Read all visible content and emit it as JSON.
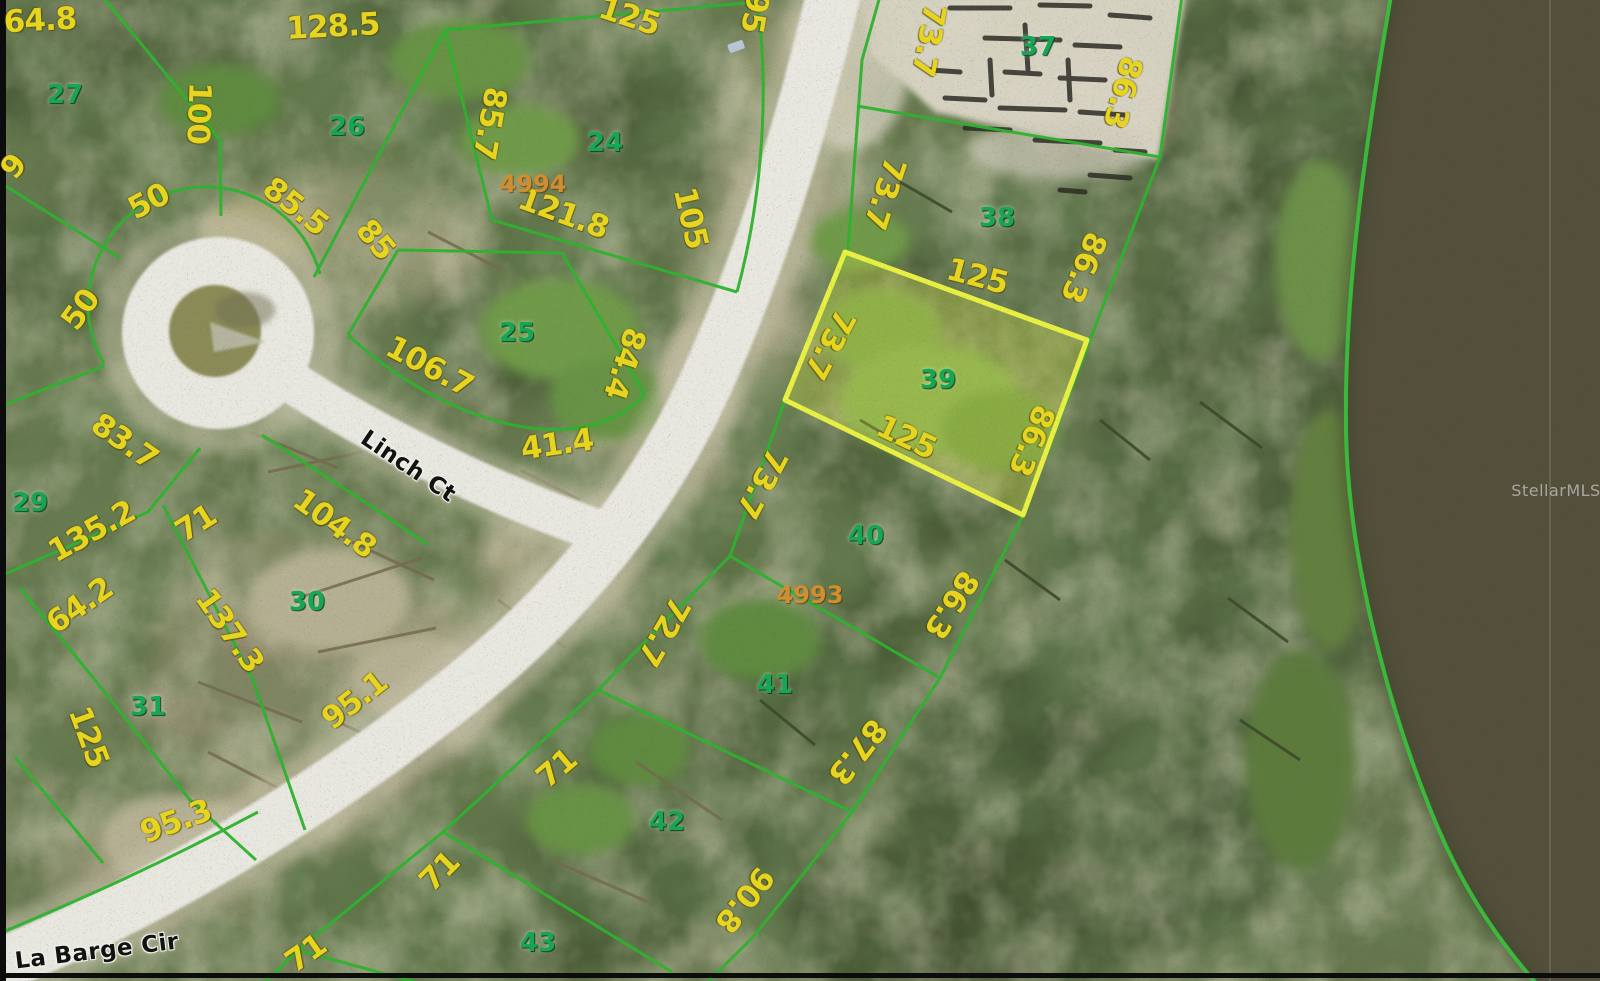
{
  "map": {
    "type": "aerial-parcel-map",
    "streets": [
      "Linch Ct",
      "La Barge Cir"
    ],
    "lot_numbers": [
      "24",
      "25",
      "26",
      "27",
      "29",
      "30",
      "31",
      "37",
      "38",
      "39",
      "40",
      "41",
      "42",
      "43"
    ],
    "parcel_ids": [
      "4994",
      "4993"
    ],
    "highlighted_lot": "39",
    "watermark": "StellarMLS",
    "colors": {
      "lot_line": "#2fb32f",
      "highlight_line": "#e9f043",
      "highlight_fill": "rgba(225,238,70,0.28)",
      "dimension_text": "#e7d41f",
      "lot_number_text": "#17a653",
      "parcel_id_text": "#d08e2e",
      "street_text": "#121212",
      "road": "#e8e7e0",
      "lake": "#53503a",
      "terrain": "#64734b"
    }
  },
  "labels": [
    {
      "t": "64.8",
      "k": "d",
      "x": 40,
      "y": 21,
      "r": -3
    },
    {
      "t": "128.5",
      "k": "d",
      "x": 333,
      "y": 27,
      "r": -3
    },
    {
      "t": "100",
      "k": "d",
      "x": 198,
      "y": 113,
      "r": 92
    },
    {
      "t": "9",
      "k": "d",
      "x": 14,
      "y": 167,
      "r": -50
    },
    {
      "t": "50",
      "k": "d",
      "x": 149,
      "y": 202,
      "r": -28
    },
    {
      "t": "85.5",
      "k": "d",
      "x": 295,
      "y": 207,
      "r": 38
    },
    {
      "t": "85",
      "k": "d",
      "x": 375,
      "y": 240,
      "r": 50
    },
    {
      "t": "50",
      "k": "d",
      "x": 81,
      "y": 310,
      "r": -54
    },
    {
      "t": "85.7",
      "k": "d",
      "x": 489,
      "y": 123,
      "r": 100
    },
    {
      "t": "125",
      "k": "d",
      "x": 629,
      "y": 17,
      "r": 18
    },
    {
      "t": "95",
      "k": "d",
      "x": 754,
      "y": 12,
      "r": 100
    },
    {
      "t": "121.8",
      "k": "d",
      "x": 563,
      "y": 214,
      "r": 20
    },
    {
      "t": "105",
      "k": "d",
      "x": 690,
      "y": 218,
      "r": 77
    },
    {
      "t": "106.7",
      "k": "d",
      "x": 429,
      "y": 367,
      "r": 28
    },
    {
      "t": "84.4",
      "k": "d",
      "x": 624,
      "y": 363,
      "r": 108
    },
    {
      "t": "41.4",
      "k": "d",
      "x": 557,
      "y": 445,
      "r": -8
    },
    {
      "t": "83.7",
      "k": "d",
      "x": 124,
      "y": 442,
      "r": 35
    },
    {
      "t": "135.2",
      "k": "d",
      "x": 92,
      "y": 532,
      "r": -29
    },
    {
      "t": "71",
      "k": "d",
      "x": 196,
      "y": 524,
      "r": -32
    },
    {
      "t": "104.8",
      "k": "d",
      "x": 334,
      "y": 524,
      "r": 36
    },
    {
      "t": "64.2",
      "k": "d",
      "x": 80,
      "y": 606,
      "r": -35
    },
    {
      "t": "137.3",
      "k": "d",
      "x": 229,
      "y": 631,
      "r": 55
    },
    {
      "t": "95.1",
      "k": "d",
      "x": 355,
      "y": 701,
      "r": -38
    },
    {
      "t": "125",
      "k": "d",
      "x": 88,
      "y": 737,
      "r": 70
    },
    {
      "t": "95.3",
      "k": "d",
      "x": 176,
      "y": 822,
      "r": -20
    },
    {
      "t": "71",
      "k": "d",
      "x": 306,
      "y": 954,
      "r": -35
    },
    {
      "t": "71",
      "k": "d",
      "x": 440,
      "y": 872,
      "r": -45
    },
    {
      "t": "71",
      "k": "d",
      "x": 557,
      "y": 769,
      "r": -40
    },
    {
      "t": "90.8",
      "k": "d",
      "x": 744,
      "y": 899,
      "r": 128
    },
    {
      "t": "72.7",
      "k": "d",
      "x": 663,
      "y": 631,
      "r": 120
    },
    {
      "t": "73.7",
      "k": "d",
      "x": 928,
      "y": 40,
      "r": 100
    },
    {
      "t": "73.7",
      "k": "d",
      "x": 884,
      "y": 193,
      "r": 108
    },
    {
      "t": "73.7",
      "k": "d",
      "x": 829,
      "y": 344,
      "r": 118
    },
    {
      "t": "73.7",
      "k": "d",
      "x": 761,
      "y": 483,
      "r": 118
    },
    {
      "t": "86.3",
      "k": "d",
      "x": 1122,
      "y": 92,
      "r": 105
    },
    {
      "t": "86.3",
      "k": "d",
      "x": 1083,
      "y": 267,
      "r": 112
    },
    {
      "t": "86.3",
      "k": "d",
      "x": 1031,
      "y": 440,
      "r": 112
    },
    {
      "t": "86.3",
      "k": "d",
      "x": 951,
      "y": 604,
      "r": 122
    },
    {
      "t": "87.3",
      "k": "d",
      "x": 857,
      "y": 751,
      "r": 128
    },
    {
      "t": "125",
      "k": "d",
      "x": 977,
      "y": 277,
      "r": 15
    },
    {
      "t": "125",
      "k": "d",
      "x": 906,
      "y": 438,
      "r": 25
    },
    {
      "t": "27",
      "k": "l",
      "x": 65,
      "y": 95,
      "r": 0
    },
    {
      "t": "26",
      "k": "l",
      "x": 347,
      "y": 127,
      "r": 0
    },
    {
      "t": "24",
      "k": "l",
      "x": 605,
      "y": 143,
      "r": 0
    },
    {
      "t": "25",
      "k": "l",
      "x": 517,
      "y": 333,
      "r": 0
    },
    {
      "t": "29",
      "k": "l",
      "x": 30,
      "y": 503,
      "r": 0
    },
    {
      "t": "30",
      "k": "l",
      "x": 307,
      "y": 602,
      "r": 0
    },
    {
      "t": "31",
      "k": "l",
      "x": 148,
      "y": 707,
      "r": 0
    },
    {
      "t": "37",
      "k": "l",
      "x": 1038,
      "y": 47,
      "r": 0
    },
    {
      "t": "38",
      "k": "l",
      "x": 997,
      "y": 218,
      "r": 0
    },
    {
      "t": "39",
      "k": "l",
      "x": 938,
      "y": 380,
      "r": 0
    },
    {
      "t": "40",
      "k": "l",
      "x": 866,
      "y": 536,
      "r": 0
    },
    {
      "t": "41",
      "k": "l",
      "x": 775,
      "y": 685,
      "r": 0
    },
    {
      "t": "42",
      "k": "l",
      "x": 667,
      "y": 822,
      "r": 0
    },
    {
      "t": "43",
      "k": "l",
      "x": 538,
      "y": 943,
      "r": 0
    },
    {
      "t": "4994",
      "k": "p",
      "x": 533,
      "y": 184,
      "r": 0
    },
    {
      "t": "4993",
      "k": "p",
      "x": 810,
      "y": 595,
      "r": 0
    },
    {
      "t": "Linch Ct",
      "k": "s",
      "x": 408,
      "y": 467,
      "r": 34
    },
    {
      "t": "La Barge Cir",
      "k": "s",
      "x": 97,
      "y": 952,
      "r": -7
    },
    {
      "t": "StellarMLS",
      "k": "w",
      "x": 1556,
      "y": 491,
      "r": 0
    }
  ]
}
